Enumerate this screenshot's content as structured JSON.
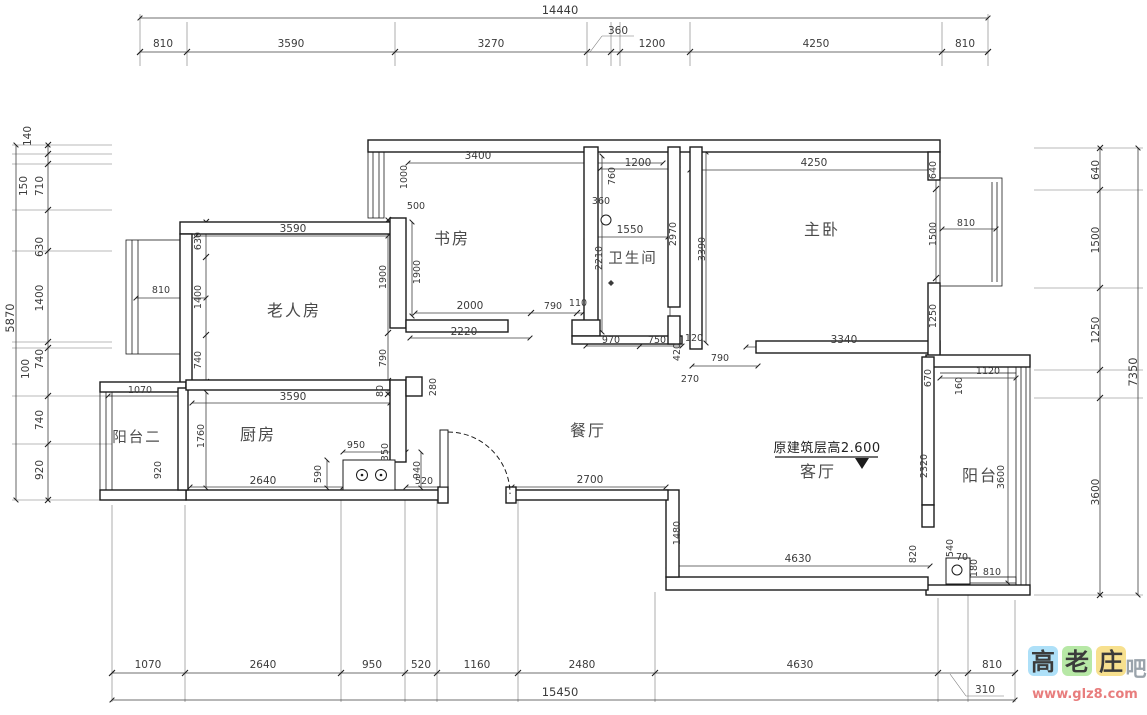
{
  "rooms": {
    "study": "书房",
    "bath": "卫生间",
    "master": "主卧",
    "elder": "老人房",
    "kitchen": "厨房",
    "dining": "餐厅",
    "living": "客厅",
    "balcony": "阳台",
    "balcony2": "阳台二"
  },
  "note": {
    "height": "原建筑层高2.600"
  },
  "dims": {
    "top": {
      "total": "14440",
      "segs": [
        "810",
        "3590",
        "3270",
        "360",
        "1200",
        "4250",
        "810"
      ]
    },
    "bottom": {
      "total": "15450",
      "extra": "310",
      "segs": [
        "1070",
        "2640",
        "950",
        "520",
        "1160",
        "2480",
        "4630",
        "810"
      ]
    },
    "left": {
      "total": "5870",
      "segs": [
        "140",
        "150",
        "710",
        "630",
        "1400",
        "100",
        "740",
        "740",
        "920"
      ]
    },
    "right": {
      "total": "7350",
      "segs": [
        "640",
        "1500",
        "1250",
        "3600"
      ]
    },
    "study": {
      "top": "3400",
      "height_upper": "1000",
      "jog": "500",
      "height": "1900",
      "floor_a": "2000",
      "floor_b": "790",
      "floor_c": "110",
      "counter": "2220"
    },
    "elder": {
      "top": "3590",
      "wall_a": "630",
      "window": "810",
      "wall_b": "1400",
      "wall_c": "740",
      "right_a": "1900",
      "right_b": "790",
      "right_c": "80",
      "bottom": "3590"
    },
    "kitchen": {
      "balcony_width": "1070",
      "inner_height": "1760",
      "balcony_height": "920",
      "floor": "2640",
      "right_a": "590",
      "counter": "950",
      "right_b": "350",
      "right_c": "940",
      "passage": "520",
      "column": "280"
    },
    "bath": {
      "top": "1200",
      "duct_h": "760",
      "duct_w": "360",
      "mid": "1550",
      "right_h": "2970",
      "left_h": "2210",
      "floor_a": "970",
      "floor_b": "750",
      "step_h": "420",
      "step_w": "120",
      "door": "790",
      "hall": "270"
    },
    "master": {
      "top": "4250",
      "right_a": "640",
      "right_b": "1500",
      "window": "810",
      "left_h": "3390",
      "right_c": "1250",
      "bottom": "3340",
      "below_a": "670",
      "below_b": "1120",
      "below_c": "160"
    },
    "dining": {
      "width": "2700",
      "step": "1480"
    },
    "living": {
      "width": "4630",
      "balcony_wall": "2320",
      "corner_a": "820",
      "corner_b": "540",
      "corner_c": "70",
      "corner_d": "180",
      "window": "810"
    },
    "balcony": {
      "height": "3600"
    }
  },
  "watermark": {
    "c1": "高",
    "c2": "老",
    "c3": "庄",
    "c4": "吧",
    "url": "www.glz8.com"
  }
}
